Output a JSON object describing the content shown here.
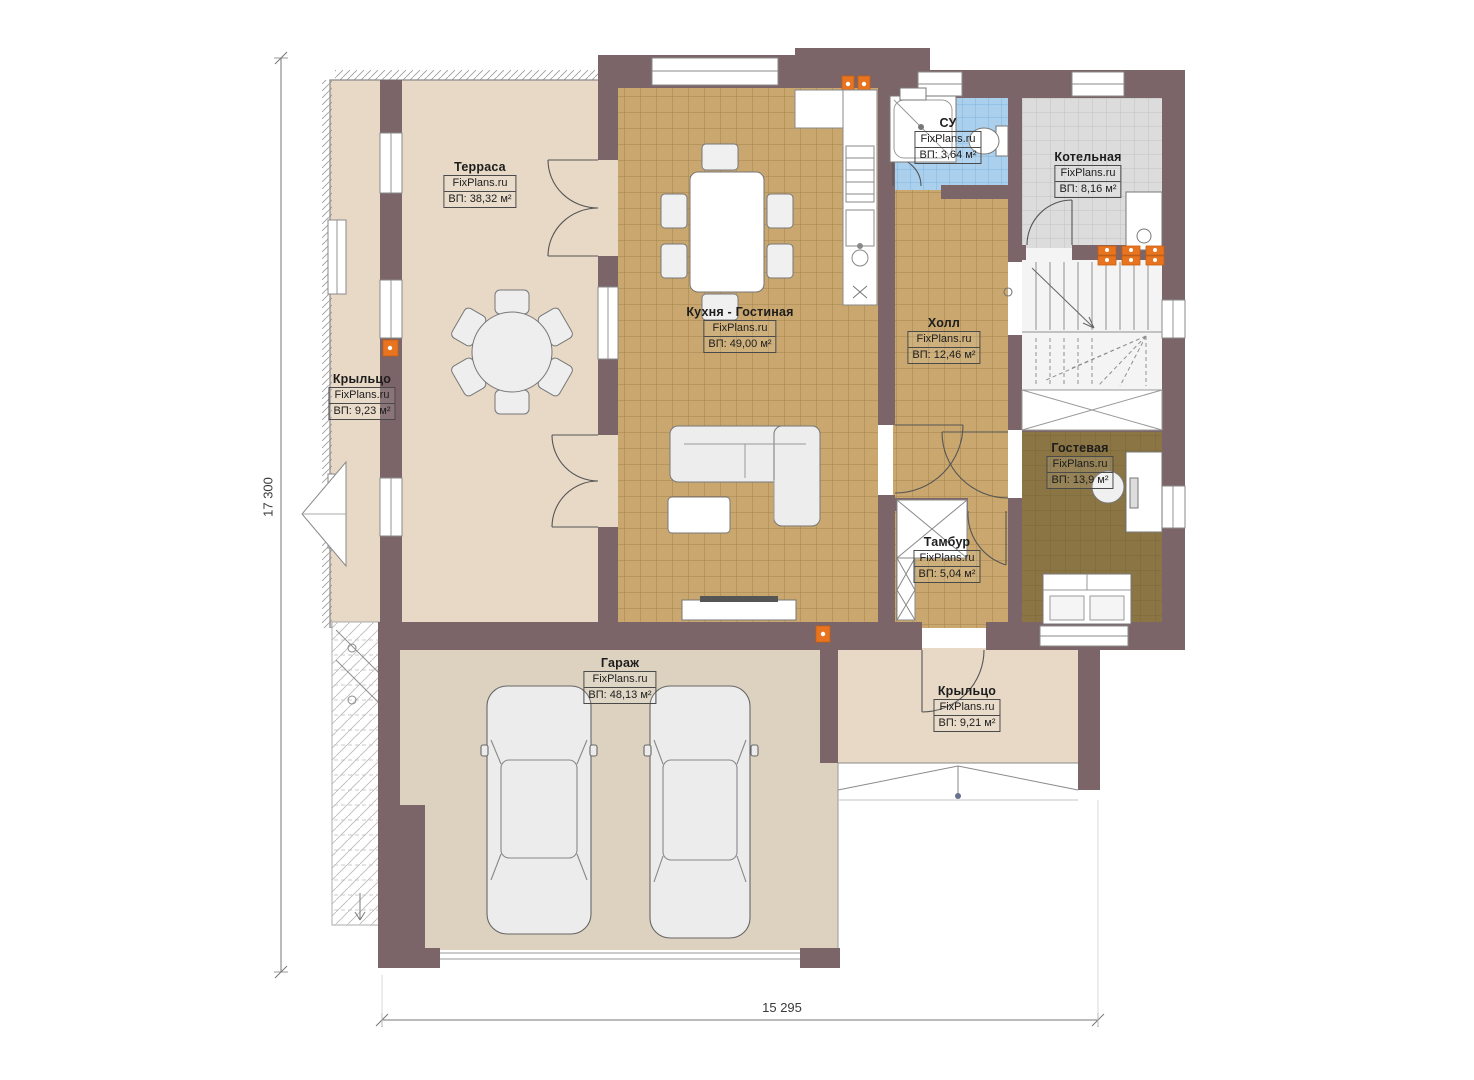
{
  "brand": "FixPlans.ru",
  "dimensions": {
    "width_label": "15 295",
    "height_label": "17 300"
  },
  "rooms": [
    {
      "key": "terrace",
      "name": "Терраса",
      "brand": "FixPlans.ru",
      "area": "ВП: 38,32 м²"
    },
    {
      "key": "kitchen_living",
      "name": "Кухня - Гостиная",
      "brand": "FixPlans.ru",
      "area": "ВП: 49,00 м²"
    },
    {
      "key": "bathroom",
      "name": "СУ",
      "brand": "FixPlans.ru",
      "area": "ВП: 3,64 м²"
    },
    {
      "key": "boiler",
      "name": "Котельная",
      "brand": "FixPlans.ru",
      "area": "ВП: 8,16 м²"
    },
    {
      "key": "hall",
      "name": "Холл",
      "brand": "FixPlans.ru",
      "area": "ВП: 12,46 м²"
    },
    {
      "key": "porch_left",
      "name": "Крыльцо",
      "brand": "FixPlans.ru",
      "area": "ВП: 9,23 м²"
    },
    {
      "key": "guest",
      "name": "Гостевая",
      "brand": "FixPlans.ru",
      "area": "ВП: 13,9 м²"
    },
    {
      "key": "vestibule",
      "name": "Тамбур",
      "brand": "FixPlans.ru",
      "area": "ВП: 5,04 м²"
    },
    {
      "key": "garage",
      "name": "Гараж",
      "brand": "FixPlans.ru",
      "area": "ВП: 48,13 м²"
    },
    {
      "key": "porch_right",
      "name": "Крыльцо",
      "brand": "FixPlans.ru",
      "area": "ВП: 9,21 м²"
    }
  ],
  "colors": {
    "wall": "#7c6568",
    "floor_beige": "#e8d9c6",
    "tile_tan": "#c9a76f",
    "tile_blue": "#abd0ed",
    "tile_gray": "#dcdcdc",
    "floor_guest": "#8b7544",
    "floor_garage": "#ddd2c0",
    "radiator_orange": "#e87420"
  }
}
